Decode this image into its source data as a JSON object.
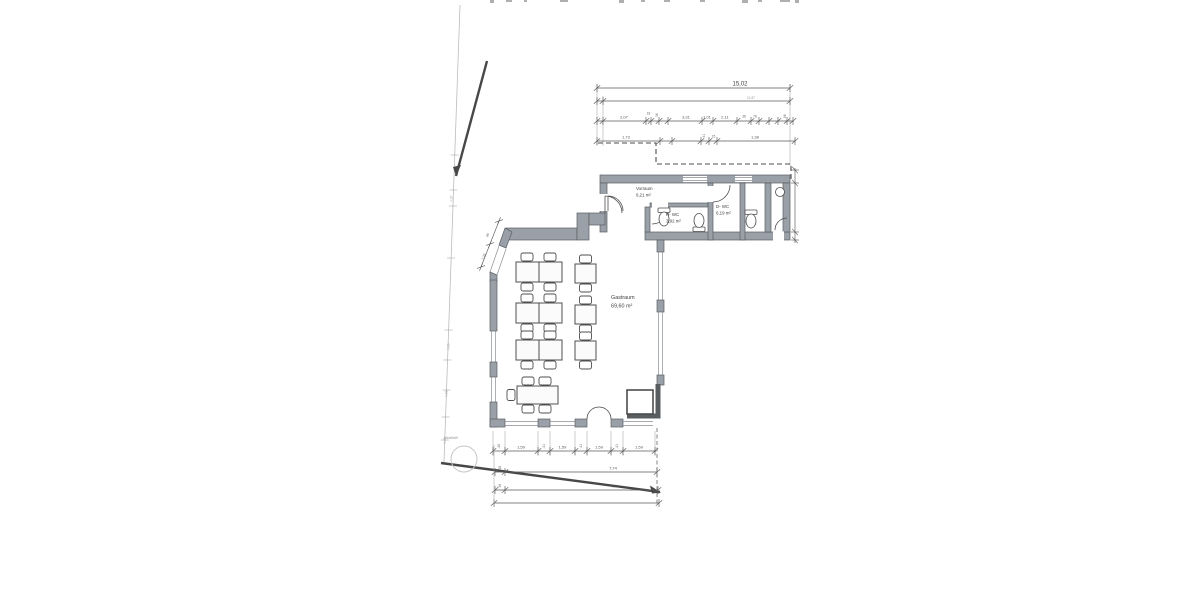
{
  "drawing": {
    "title_note": "Grundriss Gastraum (Scan)",
    "rooms": [
      {
        "name": "Vorraum",
        "area": "9,21 m²"
      },
      {
        "name": "H- WC",
        "area": "3,92 m²"
      },
      {
        "name": "D- WC",
        "area": "6,19 m²"
      },
      {
        "name": "Gastraum",
        "area": "69,60 m²"
      }
    ],
    "site_label": "Metallstift",
    "dims": {
      "top_total": "15,02",
      "top_sub": "11,87",
      "row3": [
        "2,07",
        "18",
        "36",
        "3,31",
        "1,01",
        "2,11",
        "36",
        "76",
        "86"
      ],
      "row4": [
        "1,73",
        "41",
        "15",
        "1,38"
      ],
      "left": [
        "1,37",
        "1,95",
        "1,95",
        "1,45"
      ],
      "slant": [
        "60",
        "1,26"
      ],
      "bottomA": [
        ",48",
        "1,59",
        ",41",
        "1,59",
        ",41",
        "1,59",
        ",41",
        "1,59"
      ],
      "bottomB_small": "36",
      "bottomB": "7,74",
      "bottomC_small": "36",
      "bottomC": "7,76"
    },
    "colors": {
      "paper": "#ffffff",
      "wall_fill": "#9aa0a8",
      "line": "#4c4c4c",
      "dimension": "#5a5a5a"
    }
  }
}
